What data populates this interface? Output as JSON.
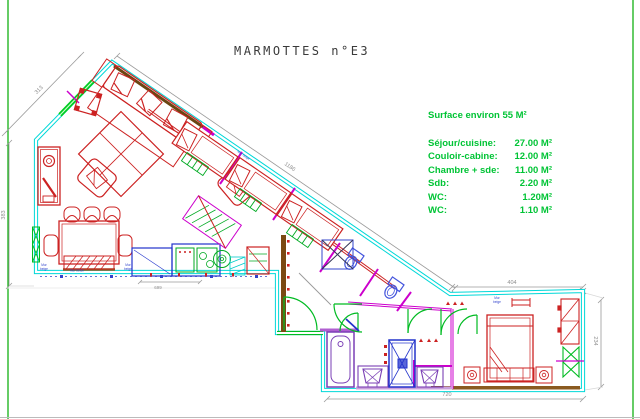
{
  "page": {
    "title": "MARMOTTES n°E3"
  },
  "surface_table": {
    "header": "Surface environ 55 M²",
    "rows": [
      {
        "label": "Séjour/cuisine:",
        "value": "27.00 M²"
      },
      {
        "label": "Couloir-cabine:",
        "value": "12.00 M²"
      },
      {
        "label": "Chambre + sde:",
        "value": "11.00 M²"
      },
      {
        "label": "Sdb:",
        "value": "2.20 M²"
      },
      {
        "label": "WC:",
        "value": "1.20M²"
      },
      {
        "label": "WC:",
        "value": "1.10 M²"
      }
    ]
  },
  "dimensions": {
    "upper_left_diagonal": "313",
    "left_wall": "383",
    "kitchen_counter": "699",
    "main_diagonal": "1186",
    "bedroom_top": "404",
    "bedroom_right": "234",
    "bottom": "720"
  },
  "wall_labels": {
    "mur": "Mur",
    "beige": "beige",
    "mur_beton": "Mur béton",
    "mur_beige": "Mur beige"
  },
  "colors": {
    "wall": "#00d8d8",
    "furniture": "#cc2222",
    "fixtures": "#2233cc",
    "doors_windows": "#00bb22",
    "partitions": "#cc00cc",
    "annotation_text": "#00c435",
    "dimension": "#999999",
    "party_wall": "#7b4a12"
  }
}
